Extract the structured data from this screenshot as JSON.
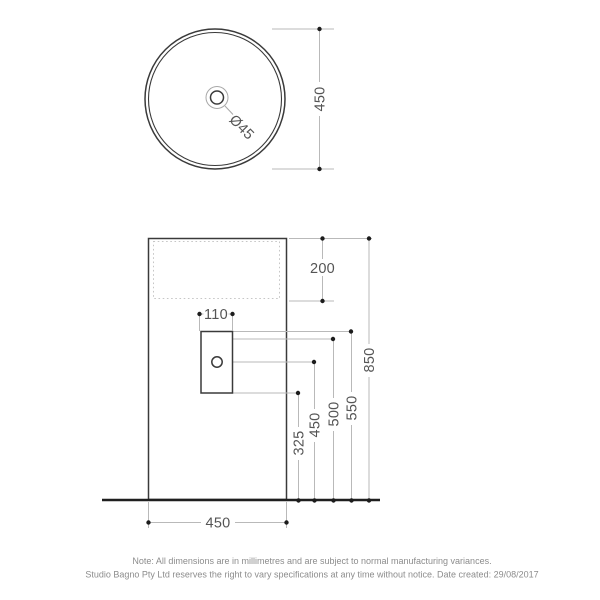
{
  "top_view": {
    "height_dim_label": "450",
    "drain_diameter_label": "Ø45"
  },
  "front_view": {
    "bowl_depth_label": "200",
    "tap_hole_width_label": "110",
    "dim_850": "850",
    "dim_550": "550",
    "dim_500": "500",
    "dim_450": "450",
    "dim_325": "325",
    "base_width_label": "450"
  },
  "note": {
    "line1": "Note: All dimensions are in millimetres and are subject to normal manufacturing variances.",
    "line2": "Studio Bagno Pty Ltd reserves the right to vary specifications at any time without notice. Date created: 29/08/2017"
  },
  "colors": {
    "background": "#ffffff",
    "outline": "#3a3a3a",
    "ground_line": "#1f1f1f",
    "dimension_line": "#b9b9b9",
    "dashed_line": "#c6c6c6",
    "dimension_dot": "#1c1c1c",
    "dimension_text": "#555555",
    "note_text": "#8c8c8c"
  }
}
